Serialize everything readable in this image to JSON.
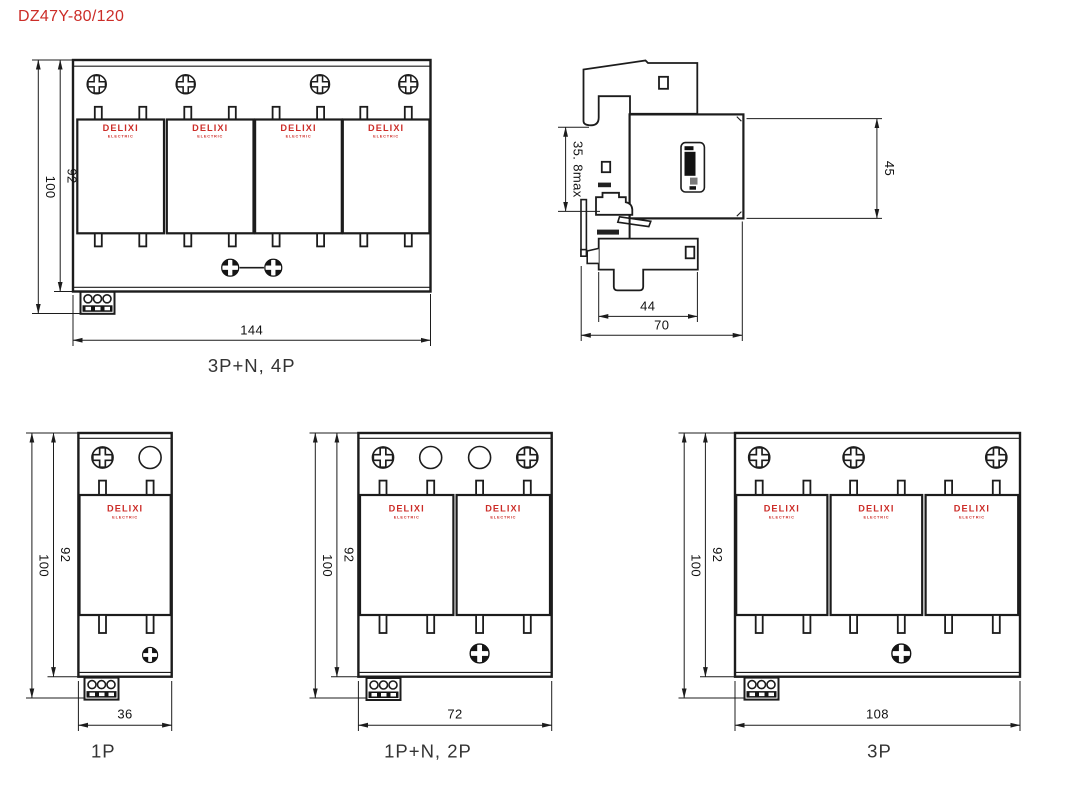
{
  "title": "DZ47Y-80/120",
  "brand": {
    "name": "DELIXI",
    "sub": "ELECTRIC"
  },
  "colors": {
    "brand_red": "#cc2d28",
    "line": "#1c1c1c"
  },
  "views": {
    "front4p": {
      "caption": "3P+N, 4P",
      "dim_total_height": "100",
      "dim_body_height": "92",
      "dim_width": "144"
    },
    "side": {
      "dim_rail_depth": "35. 8max",
      "dim_module_height": "45",
      "dim_body_depth": "44",
      "dim_total_depth": "70"
    },
    "front1p": {
      "caption": "1P",
      "dim_total_height": "100",
      "dim_body_height": "92",
      "dim_width": "36"
    },
    "front2p": {
      "caption": "1P+N, 2P",
      "dim_total_height": "100",
      "dim_body_height": "92",
      "dim_width": "72"
    },
    "front3p": {
      "caption": "3P",
      "dim_total_height": "100",
      "dim_body_height": "92",
      "dim_width": "108"
    }
  }
}
